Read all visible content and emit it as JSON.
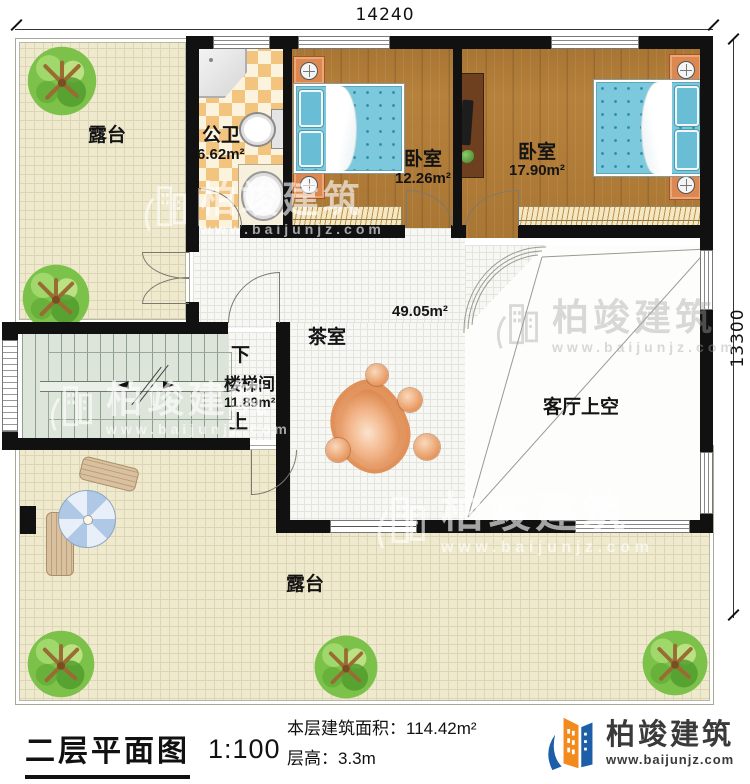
{
  "dimensions": {
    "width_label": "14240",
    "height_label": "13300"
  },
  "rooms": {
    "terrace_top": {
      "label": "露台"
    },
    "bathroom": {
      "label": "公卫",
      "area": "6.62m²"
    },
    "bedroom_left": {
      "label": "卧室",
      "area": "12.26m²"
    },
    "bedroom_right": {
      "label": "卧室",
      "area": "17.90m²"
    },
    "tea_room": {
      "label": "茶室",
      "area": "49.05m²"
    },
    "stairwell": {
      "label": "楼梯间",
      "area": "11.89m²",
      "down_label": "下",
      "up_label": "上"
    },
    "living_room_void": {
      "label": "客厅上空"
    },
    "terrace_bottom": {
      "label": "露台"
    }
  },
  "watermark": {
    "brand": "柏竣建筑",
    "website": "www.baijunjz.com"
  },
  "footer": {
    "plan_title": "二层平面图",
    "scale": "1:100",
    "floor_area_label": "本层建筑面积：",
    "floor_area_value": "114.42m²",
    "floor_height_label": "层高：",
    "floor_height_value": "3.3m",
    "brand": "柏竣建筑",
    "website": "www.baijunjz.com"
  },
  "colors": {
    "wall": "#111111",
    "wood_floor": "#b5813b",
    "terrace_floor": "#efeacd",
    "bed_blue": "#7cc9de",
    "brand_blue": "#1c5fa8",
    "brand_orange": "#f28a1e"
  }
}
